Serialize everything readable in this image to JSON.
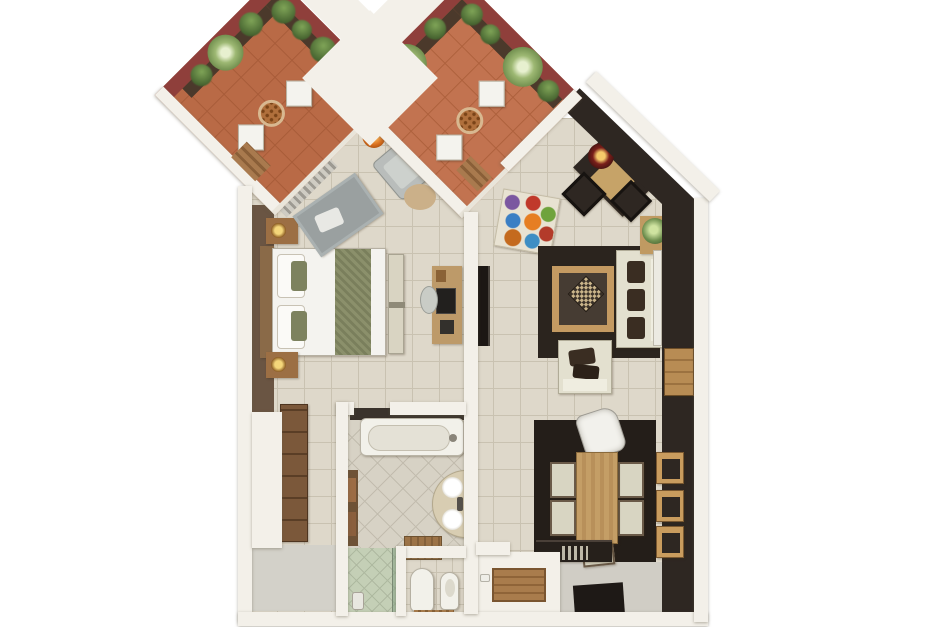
{
  "meta": {
    "kind": "3d-apartment-floor-plan-render",
    "canvas": {
      "width": 940,
      "height": 627
    },
    "background": "#ffffff",
    "visible_text": "none"
  },
  "palette": {
    "terracotta_balcony_left": "#b96a46",
    "terracotta_balcony_right": "#c27350",
    "maroon_wall": "#8f3f3b",
    "white_wall": "#f3f0e9",
    "beige_tile": "#ded8ca",
    "dark_accent_wall": "#2e2722",
    "wood": "#bd9460",
    "cream_upholstery": "#e3e0cf",
    "plant_green": "#5d7a40"
  },
  "rooms": [
    {
      "name": "balcony-left",
      "floor": "terracotta tile, diamond orientation",
      "walls": "maroon with planter boxes",
      "furniture": [
        "round lattice bistro table",
        "white chair x2",
        "wooden step",
        "planter plants"
      ]
    },
    {
      "name": "balcony-right",
      "floor": "terracotta tile, diamond orientation",
      "walls": "maroon with planter boxes",
      "furniture": [
        "round lattice bistro table",
        "white chair x2",
        "wooden step",
        "agave plant x2",
        "planter plants"
      ]
    },
    {
      "name": "bedroom",
      "furniture": [
        "double bed white duvet with green runner",
        "wood headboard",
        "nightstand with lamp x2",
        "foot bench",
        "gray area rug",
        "gray armchair",
        "orange floor lamp",
        "round tan rug",
        "gray curtains at balcony door",
        "desk with laptop",
        "desk chair",
        "brown wall panel"
      ]
    },
    {
      "name": "living-room",
      "furniture": [
        "cream sofa with dark cushions",
        "cream armchair with dark cushions",
        "wood coffee table with dark glass and patterned cushion",
        "dark area rug",
        "wall-mounted tv on divider wall",
        "multicolor circles rug",
        "corner desk with red lamp",
        "dark ottoman x2",
        "plant side table",
        "white radiator panel",
        "wood wall cabinet"
      ]
    },
    {
      "name": "dining-area",
      "furniture": [
        "wood dining table",
        "upholstered chair x5",
        "white designer chair",
        "dark rug",
        "wood wall shelf x3",
        "dark sideboard",
        "dark door mat",
        "counter with wooden tray"
      ]
    },
    {
      "name": "bathroom",
      "furniture": [
        "bathtub",
        "curved double-sink vanity",
        "towel rack",
        "wooden bath mat",
        "glass shower enclosure",
        "toilet",
        "bidet",
        "wooden wc mat"
      ]
    },
    {
      "name": "hallway",
      "furniture": [
        "tall brown wardrobe dresser"
      ]
    }
  ]
}
